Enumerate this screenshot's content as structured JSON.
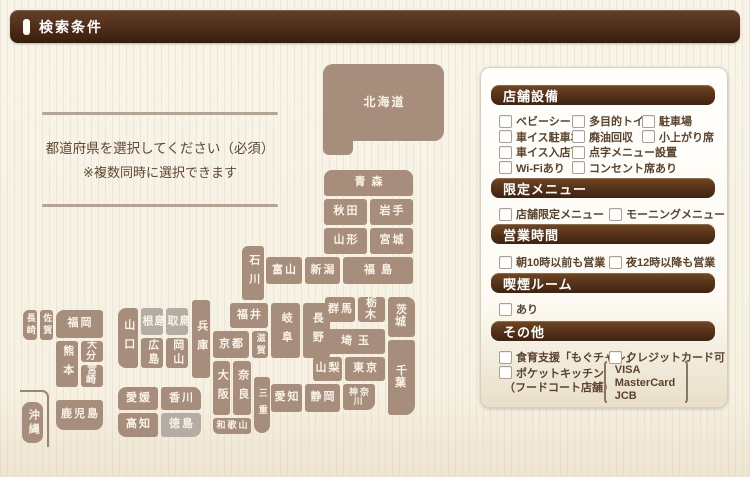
{
  "header": {
    "title": "検索条件"
  },
  "intro": {
    "line1": "都道府県を選択してください（必須）",
    "line2": "※複数同時に選択できます"
  },
  "map": {
    "tile_color": "#a78d7b",
    "tile_disabled_color": "#b5ada3",
    "tile_text_color": "#f8f3e8",
    "prefectures": [
      {
        "id": "hokkaido",
        "label": "北海道"
      },
      {
        "id": "aomori",
        "label": "青森"
      },
      {
        "id": "akita",
        "label": "秋田"
      },
      {
        "id": "iwate",
        "label": "岩手"
      },
      {
        "id": "yamagata",
        "label": "山形"
      },
      {
        "id": "miyagi",
        "label": "宮城"
      },
      {
        "id": "niigata",
        "label": "新潟"
      },
      {
        "id": "toyama",
        "label": "富山"
      },
      {
        "id": "fukushima",
        "label": "福島"
      },
      {
        "id": "ishikawa",
        "label": "石川"
      },
      {
        "id": "fukui",
        "label": "福井"
      },
      {
        "id": "gifu",
        "label": "岐阜"
      },
      {
        "id": "nagano",
        "label": "長野"
      },
      {
        "id": "gunma",
        "label": "群馬"
      },
      {
        "id": "tochigi",
        "label": "栃木"
      },
      {
        "id": "ibaraki",
        "label": "茨城"
      },
      {
        "id": "saitama",
        "label": "埼玉"
      },
      {
        "id": "yamanashi",
        "label": "山梨"
      },
      {
        "id": "tokyo",
        "label": "東京"
      },
      {
        "id": "chiba",
        "label": "千葉"
      },
      {
        "id": "kanagawa",
        "label": "神奈川"
      },
      {
        "id": "aichi",
        "label": "愛知"
      },
      {
        "id": "shizuoka",
        "label": "静岡"
      },
      {
        "id": "kyoto",
        "label": "京都"
      },
      {
        "id": "shiga",
        "label": "滋賀"
      },
      {
        "id": "hyogo",
        "label": "兵庫"
      },
      {
        "id": "osaka",
        "label": "大阪"
      },
      {
        "id": "nara",
        "label": "奈良"
      },
      {
        "id": "mie",
        "label": "三重"
      },
      {
        "id": "wakayama",
        "label": "和歌山"
      },
      {
        "id": "tottori",
        "label": "鳥取",
        "disabled": true
      },
      {
        "id": "shimane",
        "label": "島根",
        "disabled": true
      },
      {
        "id": "okayama",
        "label": "岡山"
      },
      {
        "id": "hiroshima",
        "label": "広島"
      },
      {
        "id": "yamaguchi",
        "label": "山口"
      },
      {
        "id": "ehime",
        "label": "愛媛"
      },
      {
        "id": "kagawa",
        "label": "香川"
      },
      {
        "id": "kochi",
        "label": "高知"
      },
      {
        "id": "tokushima",
        "label": "徳島",
        "disabled": true
      },
      {
        "id": "fukuoka",
        "label": "福岡"
      },
      {
        "id": "saga",
        "label": "佐賀"
      },
      {
        "id": "nagasaki",
        "label": "長崎"
      },
      {
        "id": "kumamoto",
        "label": "熊本"
      },
      {
        "id": "oita",
        "label": "大分"
      },
      {
        "id": "miyazaki",
        "label": "宮崎"
      },
      {
        "id": "kagoshima",
        "label": "鹿児島"
      },
      {
        "id": "okinawa",
        "label": "沖縄"
      }
    ]
  },
  "sidebar": {
    "sections": [
      {
        "title": "店舗設備",
        "rows": [
          [
            {
              "label": "ベビーシート",
              "col": 0
            },
            {
              "label": "多目的トイレ",
              "col": 1
            },
            {
              "label": "駐車場",
              "col": 2
            }
          ],
          [
            {
              "label": "車イス駐車場",
              "col": 0
            },
            {
              "label": "廃油回収",
              "col": 1
            },
            {
              "label": "小上がり席",
              "col": 2
            }
          ],
          [
            {
              "label": "車イス入店可",
              "col": 0
            },
            {
              "label": "点字メニュー設置",
              "col": 1
            }
          ],
          [
            {
              "label": "Wi-Fiあり",
              "col": 0
            },
            {
              "label": "コンセント席あり",
              "col": 1
            }
          ]
        ]
      },
      {
        "title": "限定メニュー",
        "rows": [
          [
            {
              "label": "店舗限定メニュー",
              "col": 0
            },
            {
              "label": "モーニングメニュー",
              "col": 3
            }
          ]
        ]
      },
      {
        "title": "営業時間",
        "rows": [
          [
            {
              "label": "朝10時以前も営業",
              "col": 0
            },
            {
              "label": "夜12時以降も営業",
              "col": 3
            }
          ]
        ]
      },
      {
        "title": "喫煙ルーム",
        "rows": [
          [
            {
              "label": "あり",
              "col": 0
            }
          ]
        ]
      },
      {
        "title": "その他",
        "rows": [
          [
            {
              "label": "食育支援「もぐチャレ」",
              "col": 0
            },
            {
              "label": "クレジットカード可",
              "col": 3
            }
          ],
          [
            {
              "label": "ポケットキッチン",
              "col": 0
            }
          ]
        ],
        "note": "（フードコート店舗）",
        "cards": [
          "VISA",
          "MasterCard",
          "JCB"
        ]
      }
    ]
  }
}
